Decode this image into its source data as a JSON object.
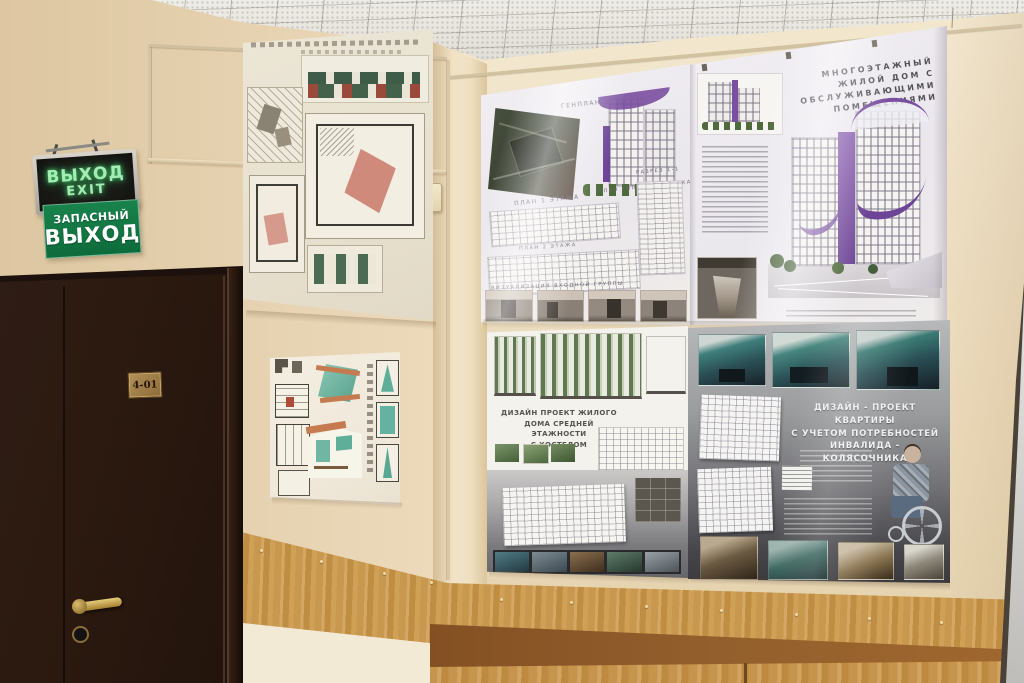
{
  "signs": {
    "exit_box": {
      "line1": "ВЫХОД",
      "line2": "EXIT"
    },
    "emergency": {
      "line1": "ЗАПАСНЫЙ",
      "line2": "ВЫХОД"
    }
  },
  "door": {
    "room_number": "4-01"
  },
  "posters": {
    "multistorey": {
      "title_lines": [
        "МНОГОЭТАЖНЫЙ",
        "ЖИЛОЙ ДОМ С",
        "ОБСЛУЖИВАЮЩИМИ",
        "ПОМЕЩЕНИЯМИ"
      ],
      "labels": {
        "genplan": "ГЕНПЛАН",
        "plan1": "ПЛАН 1 ЭТАЖА",
        "plan2": "ПЛАН 2 ЭТАЖА",
        "plan_typical": "ПЛАН ТИПОВОГО ЭТАЖА",
        "section": "РАЗРЕЗ 1-1",
        "visualization": "ВИЗУАЛИЗАЦИЯ ВХОДНОЙ ГРУППЫ"
      }
    },
    "hostel": {
      "title_lines": [
        "ДИЗАЙН ПРОЕКТ ЖИЛОГО",
        "ДОМА СРЕДНЕЙ ЭТАЖНОСТИ",
        "С ХОСТЕЛОМ"
      ]
    },
    "apartment": {
      "title_lines": [
        "ДИЗАЙН - ПРОЕКТ КВАРТИРЫ",
        "С УЧЕТОМ ПОТРЕБНОСТЕЙ",
        "ИНВАЛИДА - КОЛЯСОЧНИКА"
      ]
    }
  },
  "colors": {
    "wall_beige": "#ecdcc0",
    "wood_panel": "#c8984e",
    "door_brown": "#2b1b14",
    "sign_green": "#147a45",
    "exit_letter_green": "#a7ecb4",
    "accent_purple": "#7a4fa0",
    "poster_gray": "#8f9092",
    "render_teal": "#3f7b78"
  }
}
